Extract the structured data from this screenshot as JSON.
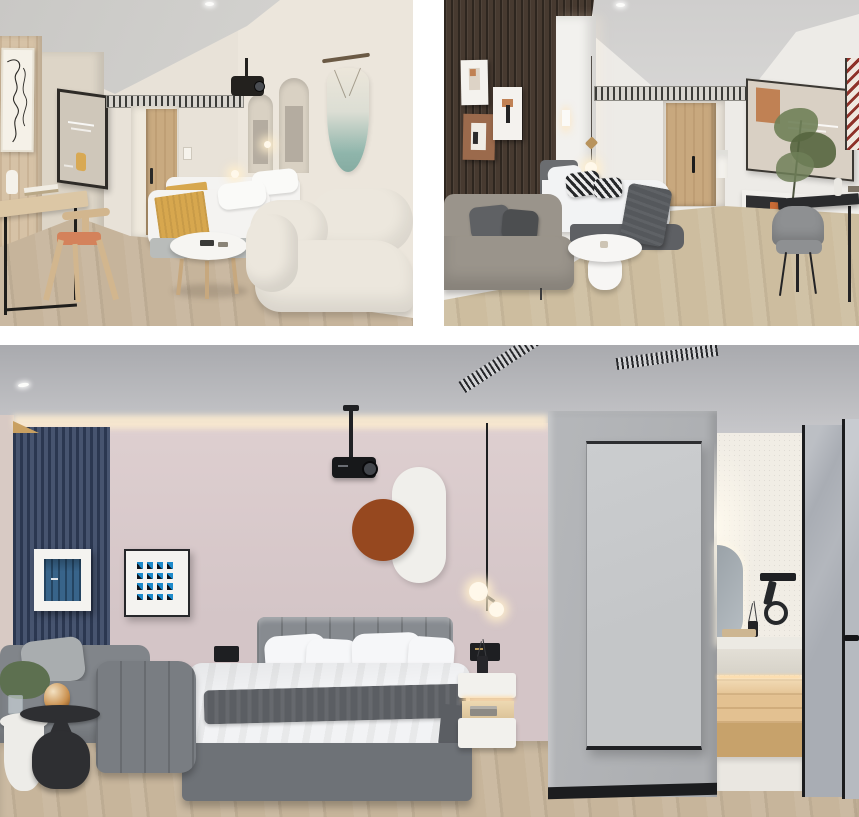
{
  "collage": {
    "type": "interior-render-collage",
    "photo_count": 3,
    "gutter_color": "#ffffff",
    "photos": [
      {
        "id": "a",
        "label": "beige twin-bed guestroom with desk, boucle sofa and macrame wall hanging"
      },
      {
        "id": "b",
        "label": "modern guestroom with dark slatted accent wall, grey sofa and black desk"
      },
      {
        "id": "c",
        "label": "pink and grey bedroom with navy slat panel, projector, wardrobe column and en-suite bathroom"
      }
    ]
  },
  "scenes": {
    "a": {
      "wall": "#e8e2d8",
      "wall_right": "#ece6dc",
      "wall_mid": "#ddd5c7",
      "ceiling": "#dbdad7",
      "ceiling_deep": "#c9c8c5",
      "wood_wall": "#d6c2a6",
      "floor": "#c6b49b",
      "corridor_floor": "#d3c4ab",
      "lineart_bg": "#f5f1e8",
      "screen_frame": "#2e2b27",
      "screen_content": "#cfc7ba",
      "desk_wood": "#dcc7a5",
      "chair_wood": "#d2b68e",
      "chair_cushion": "#d4825b",
      "bed_white": "#f4f3f1",
      "pillow_white": "#fafaf8",
      "throw_mustard": "#d7a74e",
      "bed_base": "#b9bcba",
      "sofa_cream": "#ece7dd",
      "table_white": "#f6f5f2",
      "table_leg_wood": "#c7a87e",
      "macrame_top": "#ece6da",
      "macrame_teal": "#8fb5ab",
      "macrame_rod": "#6b5a45",
      "door_wood": "#c9aa80",
      "arch_inset": "#d9d1c3",
      "arch_art": "#b4aca0",
      "projector_black": "#23211e",
      "objects": [
        "line-art-frame",
        "wood-panel-wall",
        "media-screen",
        "writing-desk",
        "wood-chair",
        "entry-door",
        "ac-vent",
        "arched-niches",
        "macrame-hanging",
        "ceiling-projector",
        "twin-beds",
        "mustard-runners",
        "coffee-table",
        "boucle-sofa"
      ]
    },
    "b": {
      "wall": "#edebe7",
      "ceiling": "#e4e3e1",
      "ceiling_deep": "#cfcecd",
      "slat_wall": "#473a30",
      "headboard_panel": "#f2f1ee",
      "frame_white": "#f4f2ee",
      "frame_terracotta": "#9b6a4c",
      "art_orange": "#c08154",
      "bed_white": "#f2f3f4",
      "throw_gray": "#55585c",
      "bed_base": "#5e6064",
      "headboard_cushion": "#6b6d70",
      "sofa_gray": "#9a948b",
      "sofa_pillow_dark": "#5f6164",
      "table_white": "#f7f6f4",
      "door_wood": "#c8a87e",
      "desk_black": "#2a2b2d",
      "chair_gray": "#8e9092",
      "plant_green": "#6f7f58",
      "plant_green_dark": "#55653f",
      "floor_carpet": "#cdbd9f",
      "artwork_red": "#8e3129",
      "artwork_bg": "#efe7df",
      "screen_content": "#d9d0c4",
      "console_white": "#f1efeb",
      "niche_dark": "#2f2f31",
      "books_orange": "#c96b35",
      "objects": [
        "slatted-accent-wall",
        "gallery-frames",
        "headboard-panel",
        "pendant-bulb",
        "ac-vent",
        "entry-door",
        "bed",
        "striped-pillows",
        "grey-sofa",
        "oval-pedestal-table",
        "wall-screen",
        "media-console",
        "potted-plant",
        "black-desk",
        "grey-chair",
        "red-print-artwork"
      ]
    },
    "c": {
      "ceiling": "#a9aaae",
      "ceiling_light": "#cbcbce",
      "wall_pink": "#decfd0",
      "wall_pink_deep": "#d4c5c7",
      "cove_glow": "#f8e8cf",
      "left_wall": "#d8cac4",
      "slat_navy_dark": "#2b3750",
      "slat_navy_light": "#47546f",
      "cove_wood": "#c9a061",
      "frame_white": "#f4f3f0",
      "frame_black": "#2a2b2e",
      "art_door_blue": "#38648a",
      "art_tile_blue": "#1d8aca",
      "capsule_white": "#f0efeb",
      "circle_terracotta": "#96481f",
      "projector_black": "#17181a",
      "headboard_gray": "#878b90",
      "bed_base_gray": "#6e7277",
      "duvet_white": "#f2f3f5",
      "pillow_white": "#f6f7f9",
      "throw_gray": "#5b5e63",
      "sofa_gray": "#81858a",
      "sofa_arm": "#797d82",
      "pillow_light": "#a9adaf",
      "table_black": "#2e2f32",
      "table_white": "#edece8",
      "side_table_white": "#efeeea",
      "nightstand_white": "#f2f1ed",
      "led_glow": "#ffd9a0",
      "switch_black": "#1e1f22",
      "floor_wood": "#c7b59b",
      "column_gray": "#b5b7ba",
      "panel_gray": "#c4c6c8",
      "panel_frame": "#2c2d30",
      "baseboard_black": "#1c1d1f",
      "bathroom_wall": "#f1ede5",
      "bathroom_counter": "#eceae3",
      "bathroom_wood": "#e3c191",
      "bathroom_wood_dark": "#c7a26b",
      "bathroom_floor": "#eae7e1",
      "glass_gray": "#a9adb4",
      "glass_gray_light": "#b6bac0",
      "glass_frame": "#1b1c1e",
      "amber_glass": "#c98f4d",
      "plant_green": "#5d7050",
      "grid_art": {
        "rows": 4,
        "cols": 4
      },
      "objects": [
        "navy-slat-panel",
        "blue-door-artwork",
        "blue-grid-artwork",
        "capsule-wall-decor",
        "terracotta-circle",
        "ceiling-projector",
        "linear-vents",
        "tufted-bed",
        "pendant-globes",
        "floating-nightstand",
        "diffuser",
        "modular-sofa",
        "nesting-black-tables",
        "amber-glass-decor",
        "wardrobe-column",
        "framed-panel",
        "ensuite-mirror",
        "wall-hairdryer",
        "vanity-counter",
        "lit-shelves",
        "glass-doors"
      ]
    }
  }
}
